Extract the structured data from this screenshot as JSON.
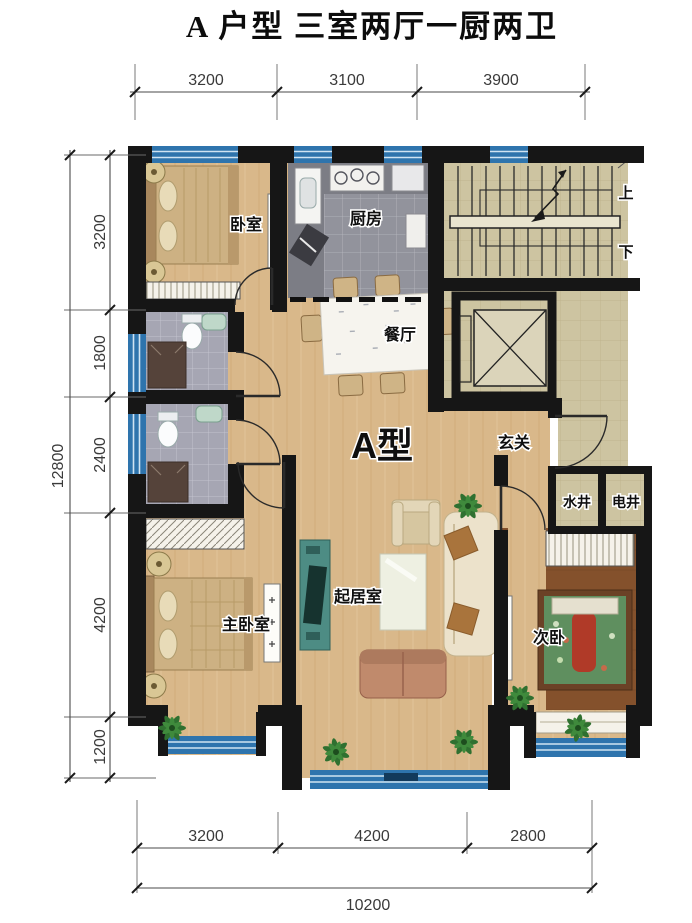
{
  "title": "A 户型 三室两厅一厨两卫",
  "dimensions": {
    "top": [
      "3200",
      "3100",
      "3900"
    ],
    "left": [
      "3200",
      "1800",
      "2400",
      "4200",
      "1200"
    ],
    "left_total": "12800",
    "bottom": [
      "3200",
      "4200",
      "2800"
    ],
    "bottom_total": "10200"
  },
  "rooms": {
    "bedroom": "卧室",
    "kitchen": "厨房",
    "dining_room": "餐厅",
    "unit_type": "A型",
    "entry": "玄关",
    "water_shaft": "水井",
    "electric_shaft": "电井",
    "living_room": "起居室",
    "master_bedroom": "主卧室",
    "second_bedroom": "次卧",
    "stairs_up": "上",
    "stairs_down": "下"
  },
  "colors": {
    "wall": "#161616",
    "window_blue": "#2e74ad",
    "window_light": "#9cc4e0",
    "wood_floor": "#d9b88a",
    "kitchen_tile": "#92939c",
    "bath_tile": "#a6a6b3",
    "stair_tile": "#cdc4a1",
    "bedroom2_floor": "#84512c",
    "cabinet_teal": "#4d8c84",
    "dim_text": "#3a3a3a"
  }
}
